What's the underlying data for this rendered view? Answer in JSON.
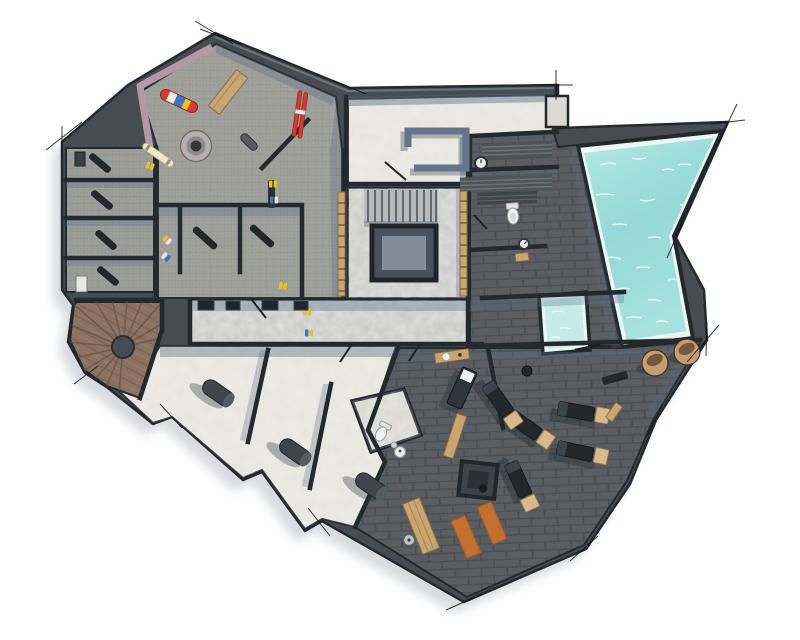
{
  "scene": {
    "kind": "architectural-floor-plan-render",
    "view": "top-down",
    "level": "basement-spa-level"
  },
  "palette": {
    "background": "#ffffff",
    "wall_fill": "#474c52",
    "wall_line": "#24292e",
    "wall_top": "#7b8490",
    "shadow_blue": "#5d6c82",
    "floor_ski": "#9c9c98",
    "floor_brick": "#5a5e62",
    "floor_cream": "#e7e5df",
    "floor_marble": "#d2d1ce",
    "floor_wood": "#8b7262",
    "water": "#9edcda",
    "water_light": "#c6ebe9",
    "pool_rim": "#eaf5f4",
    "wood_accent": "#c9a56f",
    "mat_orange": "#c2702f",
    "ski_red": "#d23b2d",
    "board_red": "#d63a2e",
    "boot_yellow": "#e6c32c",
    "boot_blue": "#4472c4",
    "mauve": "#b499a4",
    "stool_tan": "#c49e71",
    "stool_dark": "#75573a",
    "machine_dark": "#23272c",
    "machine_pad": "#d9b98c",
    "cylinder": "#40454b",
    "porcelain": "#f4f4f2"
  },
  "inventory": {
    "pool": {
      "shape": "tapered-pentagon",
      "water": "teal"
    },
    "plunge_pool": {
      "shape": "square",
      "water": "pale-teal"
    },
    "stairwell": {
      "treads": 11,
      "open_void": true,
      "wood_rails": 2
    },
    "spiral_staircase": {
      "style": "radial-wood-fan"
    },
    "ski_room": {
      "snowboard": 1,
      "ski_pairs": 2,
      "boot_pairs": 8,
      "round_boot_dryer": 1,
      "wood_bench": 1
    },
    "storage_cubicles": {
      "count": 7,
      "benches": 6,
      "appliances": 2
    },
    "cellar_rooms": {
      "count": 3,
      "cylinder_objects": 3
    },
    "bathroom": {
      "toilet": 1,
      "sink": 1
    },
    "massage_room": {
      "table": 1,
      "side_table": 1
    },
    "spa": {
      "toilet": 1,
      "wall_gauges": 2,
      "bench_bands": 3,
      "mat": 1
    },
    "terrace": {
      "stools": 2
    },
    "gym": {
      "machines": 5,
      "orange_mats": 2,
      "plyo_box": 1,
      "wood_planks": 2,
      "disc": 1
    }
  }
}
